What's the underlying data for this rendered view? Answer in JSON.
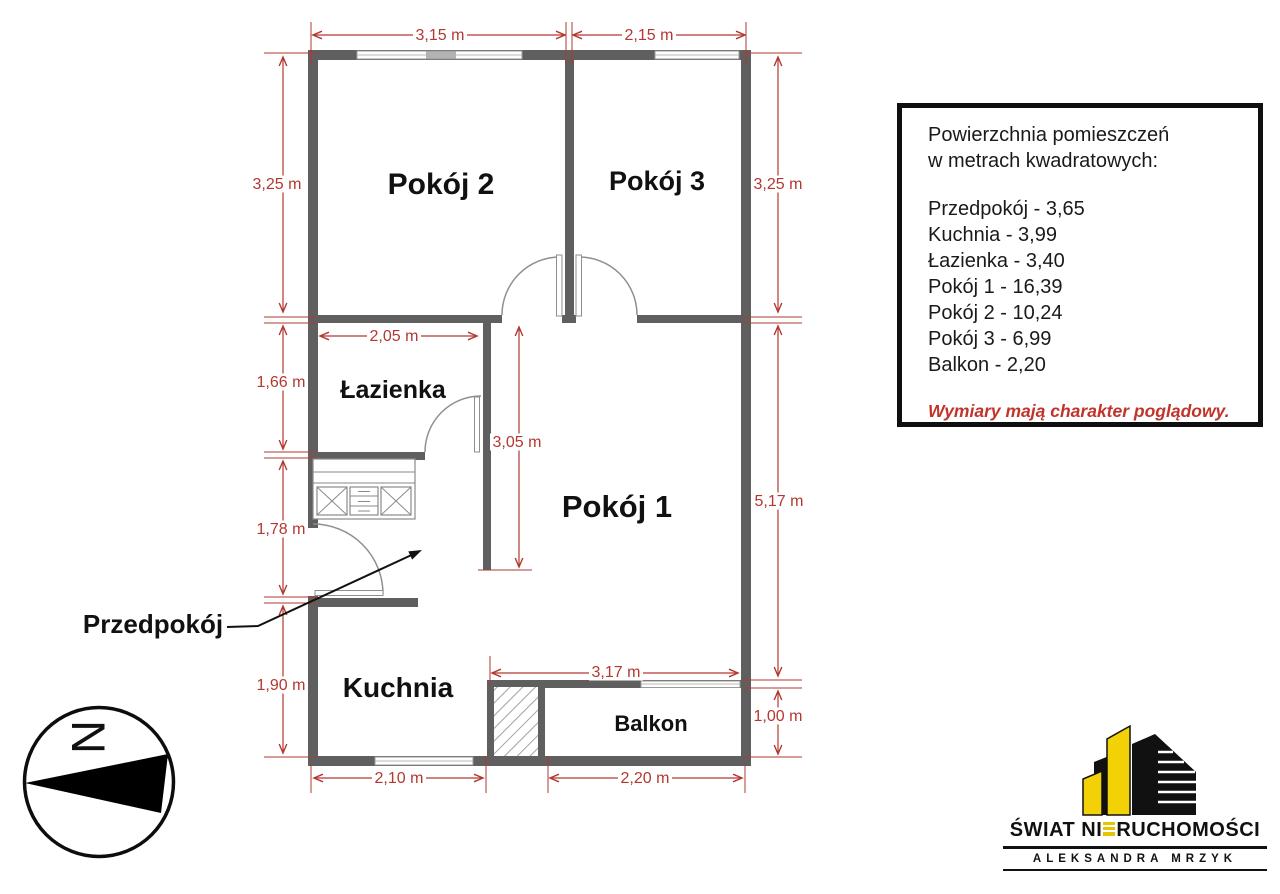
{
  "plan": {
    "rooms": [
      {
        "id": "pokoj2",
        "label": "Pokój 2"
      },
      {
        "id": "pokoj3",
        "label": "Pokój 3"
      },
      {
        "id": "lazienka",
        "label": "Łazienka"
      },
      {
        "id": "pokoj1",
        "label": "Pokój 1"
      },
      {
        "id": "przedpokoj",
        "label": "Przedpokój"
      },
      {
        "id": "kuchnia",
        "label": "Kuchnia"
      },
      {
        "id": "balkon",
        "label": "Balkon"
      }
    ],
    "dimensions": [
      "3,15 m",
      "2,15 m",
      "3,25 m",
      "1,66 m",
      "1,78 m",
      "1,90 m",
      "3,25 m",
      "5,17 m",
      "1,00 m",
      "2,05 m",
      "3,05 m",
      "3,17 m",
      "2,10 m",
      "2,20 m"
    ]
  },
  "info_box": {
    "line1": "Powierzchnia pomieszczeń",
    "line2": "w metrach kwadratowych:",
    "rows": [
      "Przedpokój - 3,65",
      "Kuchnia - 3,99",
      "Łazienka - 3,40",
      "Pokój 1 - 16,39",
      "Pokój 2 - 10,24",
      "Pokój 3 - 6,99",
      "Balkon - 2,20"
    ],
    "disclaimer": "Wymiary mają charakter poglądowy."
  },
  "compass": {
    "north_letter": "N"
  },
  "logo": {
    "brand_prefix": "ŚWIAT NI",
    "brand_suffix": "RUCHOMOŚCI",
    "subtitle": "ALEKSANDRA MRZYK"
  },
  "colors": {
    "wall_gray": "#5f5f5f",
    "dimension_red": "#b23831",
    "disclaimer_red": "#c0342c",
    "logo_yellow": "#f2d207"
  }
}
